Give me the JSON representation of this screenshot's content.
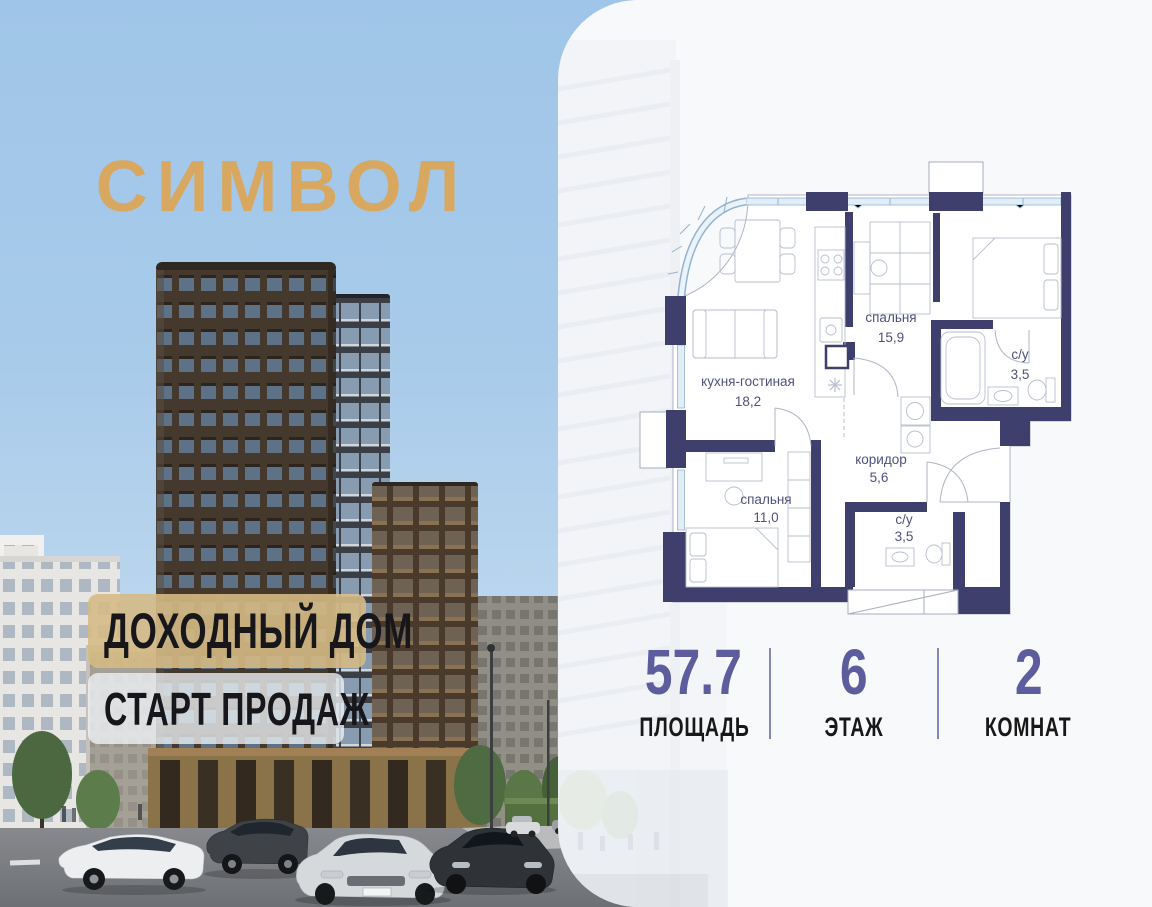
{
  "brand": {
    "logo": "СИМВОЛ",
    "logo_color": "#d8a760"
  },
  "banners": [
    {
      "text": "ДОХОДНЫЙ ДОМ",
      "style": "gold"
    },
    {
      "text": "СТАРТ ПРОДАЖ",
      "style": "light"
    }
  ],
  "floorplan": {
    "rooms": [
      {
        "name": "кухня-гостиная",
        "area": "18,2"
      },
      {
        "name": "спальня",
        "area": "15,9"
      },
      {
        "name": "с/у",
        "area": "3,5"
      },
      {
        "name": "коридор",
        "area": "5,6"
      },
      {
        "name": "спальня",
        "area": "11,0"
      },
      {
        "name": "с/у",
        "area": "3,5"
      }
    ],
    "wall_color": "#3f3f6e",
    "window_color": "#e2eef7",
    "label_color": "#50507f"
  },
  "stats": [
    {
      "value": "57.7",
      "label": "ПЛОЩАДЬ"
    },
    {
      "value": "6",
      "label": "ЭТАЖ"
    },
    {
      "value": "2",
      "label": "КОМНАТ"
    }
  ],
  "colors": {
    "accent_gold": "#d8a760",
    "stat_purple": "#5d5d9e",
    "banner_gold": "#d5ba85",
    "sky_blue": "#a8cbea"
  }
}
